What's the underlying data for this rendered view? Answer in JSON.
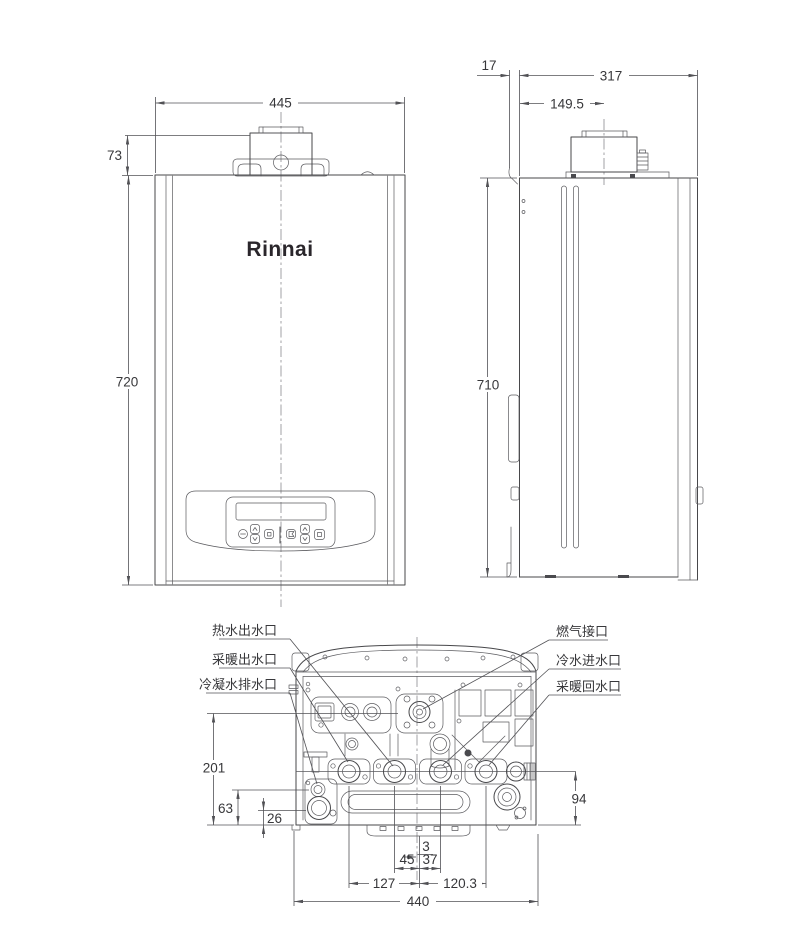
{
  "drawing": {
    "front": {
      "logo": "Rinnai",
      "dim_width": "445",
      "dim_top_height": "73",
      "dim_height": "720"
    },
    "side": {
      "dim_bracket_offset": "17",
      "dim_depth": "317",
      "dim_flue_center": "149.5",
      "dim_height": "710"
    },
    "bottom": {
      "dim_gas_height": "201",
      "dim_condensate_height": "63",
      "dim_drain_height": "26",
      "dim_ports_height": "94",
      "dim_center_offset": "3",
      "dim_hot_water": "45",
      "dim_cold_water": "37",
      "dim_heating_flow": "127",
      "dim_heating_return": "120.3",
      "dim_width": "440",
      "labels": {
        "hot_water_outlet": "热水出水口",
        "heating_outlet": "采暖出水口",
        "condensate_drain": "冷凝水排水口",
        "gas_connection": "燃气接口",
        "cold_water_inlet": "冷水进水口",
        "heating_return": "采暖回水口"
      }
    }
  }
}
